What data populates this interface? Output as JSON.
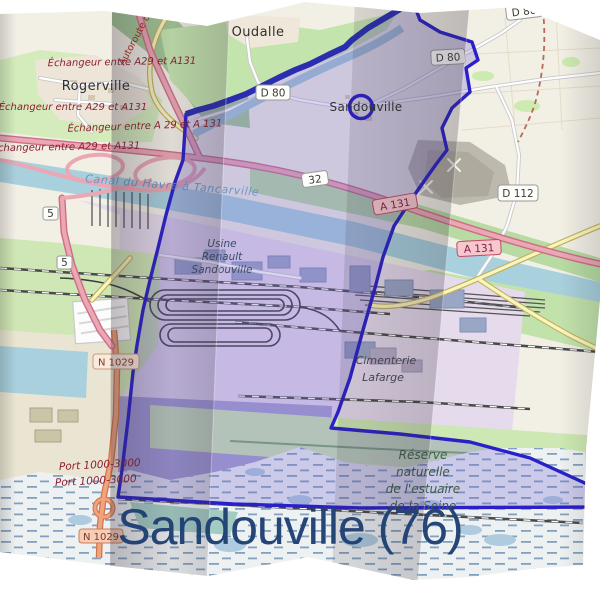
{
  "title": "Sandouville (76)",
  "map": {
    "labels": {
      "places": {
        "rogerville": "Rogerville",
        "oudalle": "Oudalle",
        "sandouville": "Sandouville"
      },
      "interchanges": [
        "Échangeur entre A29 et A131",
        "Échangeur entre A29 et A131",
        "Échangeur entre A 29 et A 131",
        "Échangeur entre A29 et A131"
      ],
      "motorway_name": "Autoroute d",
      "canal": "Canal du Havre à Tancarville",
      "usine_lines": [
        "Usine",
        "Renault",
        "Sandouville"
      ],
      "cimenterie_lines": [
        "Cimenterie",
        "Lafarge"
      ],
      "reserve_lines": [
        "Réserve",
        "naturelle",
        "de l'estuaire",
        "de la Seine"
      ],
      "ports": [
        "Port 1000-3000",
        "Port 1000-3000"
      ],
      "exit_numbers": [
        "5",
        "5"
      ]
    },
    "badges": {
      "d80_a": "D 80",
      "d80_b": "D 80",
      "d80_top": "D 80",
      "d112": "D 112",
      "a131_a": "A 131",
      "a131_b": "A 131",
      "n1029_a": "N 1029",
      "n1029_b": "N 1029",
      "junction32": "32"
    },
    "colors": {
      "boundary": "#2a20c8",
      "boundary_fill": "rgba(116,102,208,0.28)",
      "title_text": "#1e4073",
      "water": "#a8d0dd",
      "wetland_dash": "#5f86ad",
      "motorway": "#eba7b4",
      "badge_red_bg": "#f7c6ce",
      "badge_white_bg": "#fdfdfa",
      "badge_orange_bg": "#f8cdb8"
    }
  }
}
